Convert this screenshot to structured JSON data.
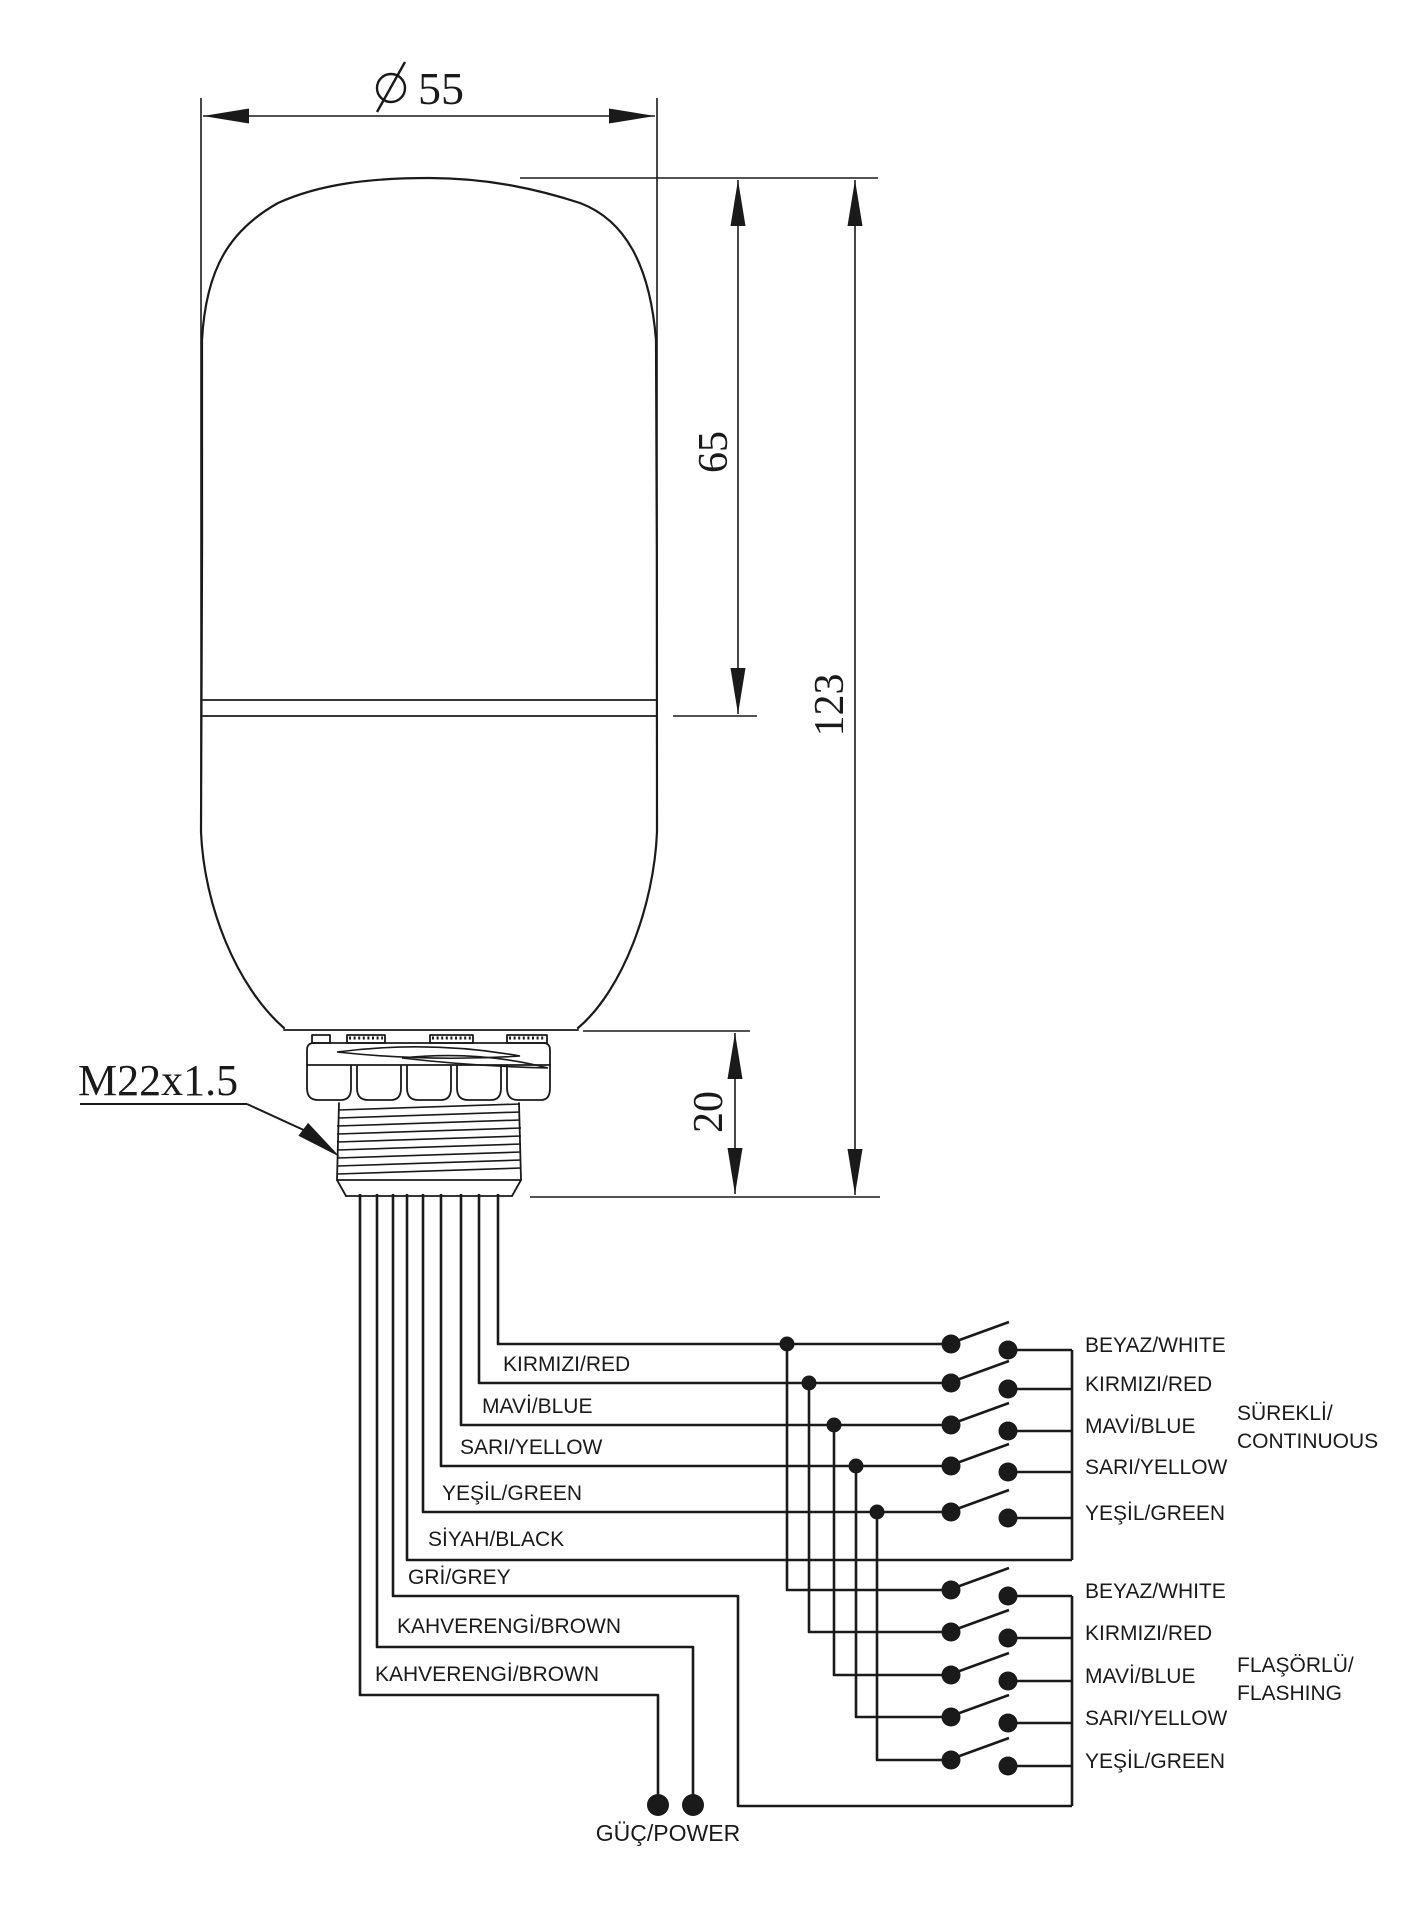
{
  "colors": {
    "ink": "#1a1a1a",
    "background": "#ffffff"
  },
  "dimensions": {
    "diameter": "55",
    "upper_height": "65",
    "total_height": "123",
    "thread_height": "20",
    "thread_spec": "M22x1.5"
  },
  "wire_labels": [
    "KIRMIZI/RED",
    "MAVİ/BLUE",
    "SARI/YELLOW",
    "YEŞİL/GREEN",
    "SİYAH/BLACK",
    "GRİ/GREY",
    "KAHVERENGİ/BROWN",
    "KAHVERENGİ/BROWN"
  ],
  "power_label": "GÜÇ/POWER",
  "switch_groups": [
    {
      "label_line1": "SÜREKLİ/",
      "label_line2": "CONTINUOUS",
      "rows": [
        "BEYAZ/WHITE",
        "KIRMIZI/RED",
        "MAVİ/BLUE",
        "SARI/YELLOW",
        "YEŞİL/GREEN"
      ]
    },
    {
      "label_line1": "FLAŞÖRLÜ/",
      "label_line2": "FLASHING",
      "rows": [
        "BEYAZ/WHITE",
        "KIRMIZI/RED",
        "MAVİ/BLUE",
        "SARI/YELLOW",
        "YEŞİL/GREEN"
      ]
    }
  ]
}
